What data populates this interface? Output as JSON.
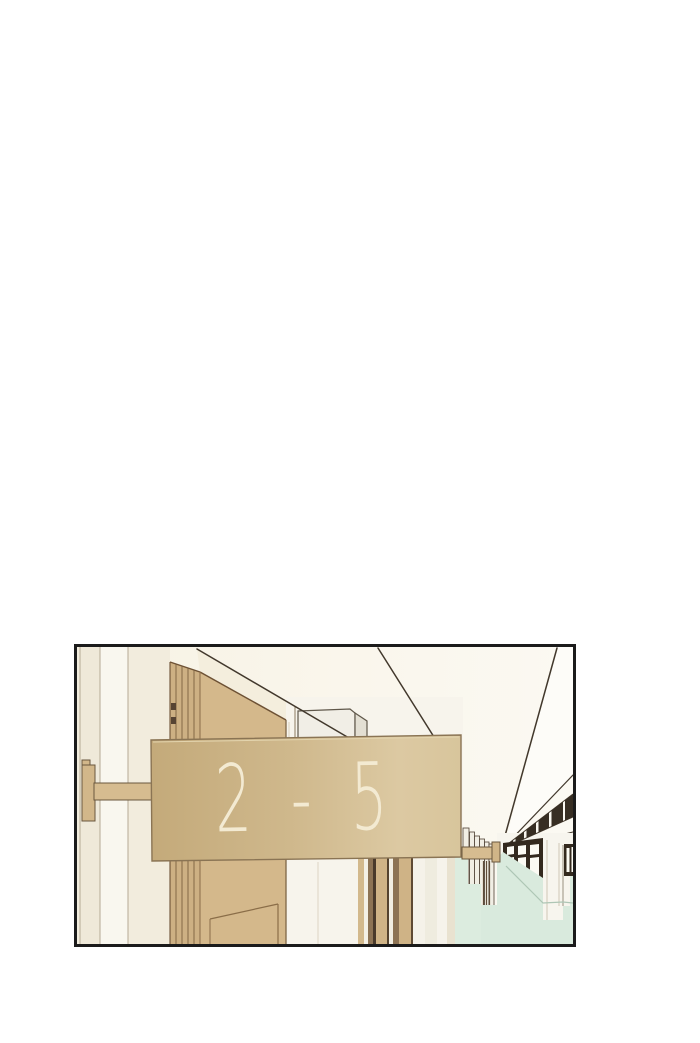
{
  "panel": {
    "kind": "webtoon-comic-panel",
    "scene": "school hallway with classroom door and hanging class number sign",
    "sign": {
      "label": "2 - 5",
      "text_color": "#f3ead2",
      "plate_left_color": "#c5ab7c",
      "plate_right_color": "#ddcba4"
    },
    "colors": {
      "page_background": "#ffffff",
      "panel_border": "#1b1b1b",
      "ceiling": "#faf6ec",
      "near_wall": "#f2edde",
      "door": "#d4b88b",
      "door_frame": "#cdb083",
      "white_wall": "#f7f4ec",
      "mint_wainscot": "#d9eadd",
      "window_frame": "#33291e",
      "light_fixture": "#372e23",
      "bracket": "#d6bc90"
    }
  }
}
